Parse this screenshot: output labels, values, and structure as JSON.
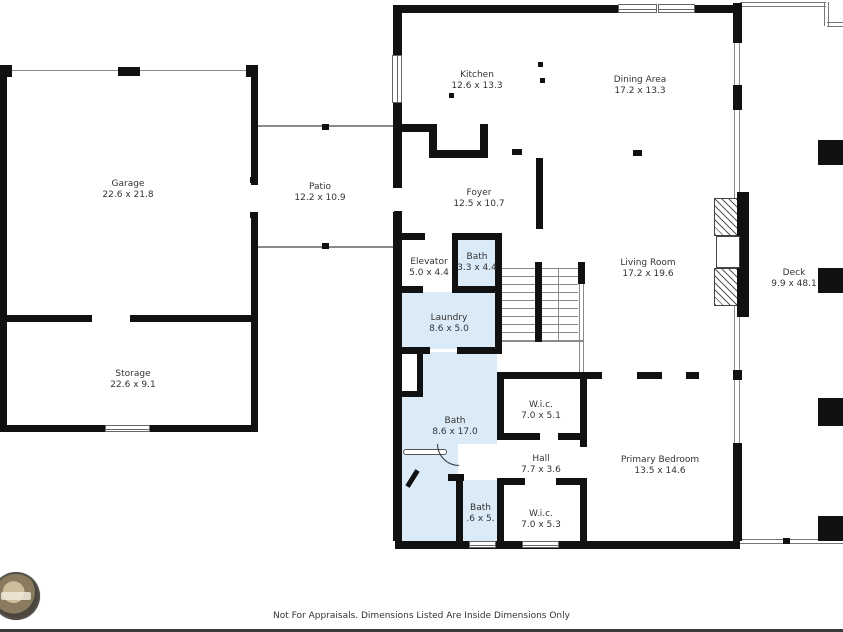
{
  "meta": {
    "type": "residential-floor-plan"
  },
  "colors": {
    "wall": "#111111",
    "bath_fill": "#daeaf6",
    "thin_line": "#8a8a8a",
    "text": "#333333"
  },
  "rooms": [
    {
      "id": "garage",
      "name": "Garage",
      "dims": "22.6 x 21.8"
    },
    {
      "id": "storage",
      "name": "Storage",
      "dims": "22.6 x 9.1"
    },
    {
      "id": "patio",
      "name": "Patio",
      "dims": "12.2 x 10.9"
    },
    {
      "id": "kitchen",
      "name": "Kitchen",
      "dims": "12.6 x 13.3"
    },
    {
      "id": "dining",
      "name": "Dining Area",
      "dims": "17.2 x 13.3"
    },
    {
      "id": "foyer",
      "name": "Foyer",
      "dims": "12.5 x 10.7"
    },
    {
      "id": "elevator",
      "name": "Elevator",
      "dims": "5.0 x 4.4"
    },
    {
      "id": "bath-upper",
      "name": "Bath",
      "dims": "3.3 x 4.4"
    },
    {
      "id": "living",
      "name": "Living Room",
      "dims": "17.2 x 19.6"
    },
    {
      "id": "deck",
      "name": "Deck",
      "dims": "9.9 x 48.1"
    },
    {
      "id": "laundry",
      "name": "Laundry",
      "dims": "8.6 x 5.0"
    },
    {
      "id": "bath-main",
      "name": "Bath",
      "dims": "8.6 x 17.0"
    },
    {
      "id": "wic-1",
      "name": "W.i.c.",
      "dims": "7.0 x 5.1"
    },
    {
      "id": "hall",
      "name": "Hall",
      "dims": "7.7 x 3.6"
    },
    {
      "id": "primary",
      "name": "Primary Bedroom",
      "dims": "13.5 x 14.6"
    },
    {
      "id": "bath-lower",
      "name": "Bath",
      "dims": ".6 x 5."
    },
    {
      "id": "wic-2",
      "name": "W.i.c.",
      "dims": "7.0 x 5.3"
    }
  ],
  "footer": {
    "disclaimer": "Not For Appraisals. Dimensions Listed Are Inside Dimensions Only"
  }
}
